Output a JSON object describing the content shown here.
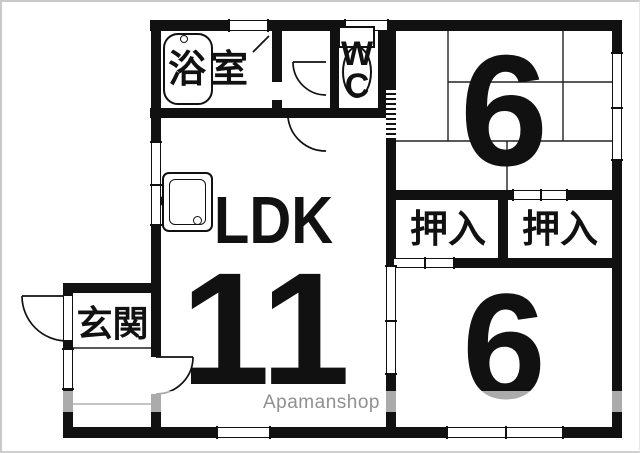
{
  "floorplan": {
    "labels": {
      "bathroom": "浴室",
      "wc_line1": "W",
      "wc_line2": "C",
      "entrance": "玄関",
      "ldk": "LDK",
      "ldk_tatami": "11",
      "bedroom_north": "6",
      "bedroom_south": "6",
      "closet_west": "押入",
      "closet_east": "押入"
    },
    "watermark": "Apamanshop",
    "colors": {
      "wall": "#111111",
      "background": "#ffffff",
      "watermark_text": "#909090",
      "frame_border": "#c9c9c9"
    }
  }
}
